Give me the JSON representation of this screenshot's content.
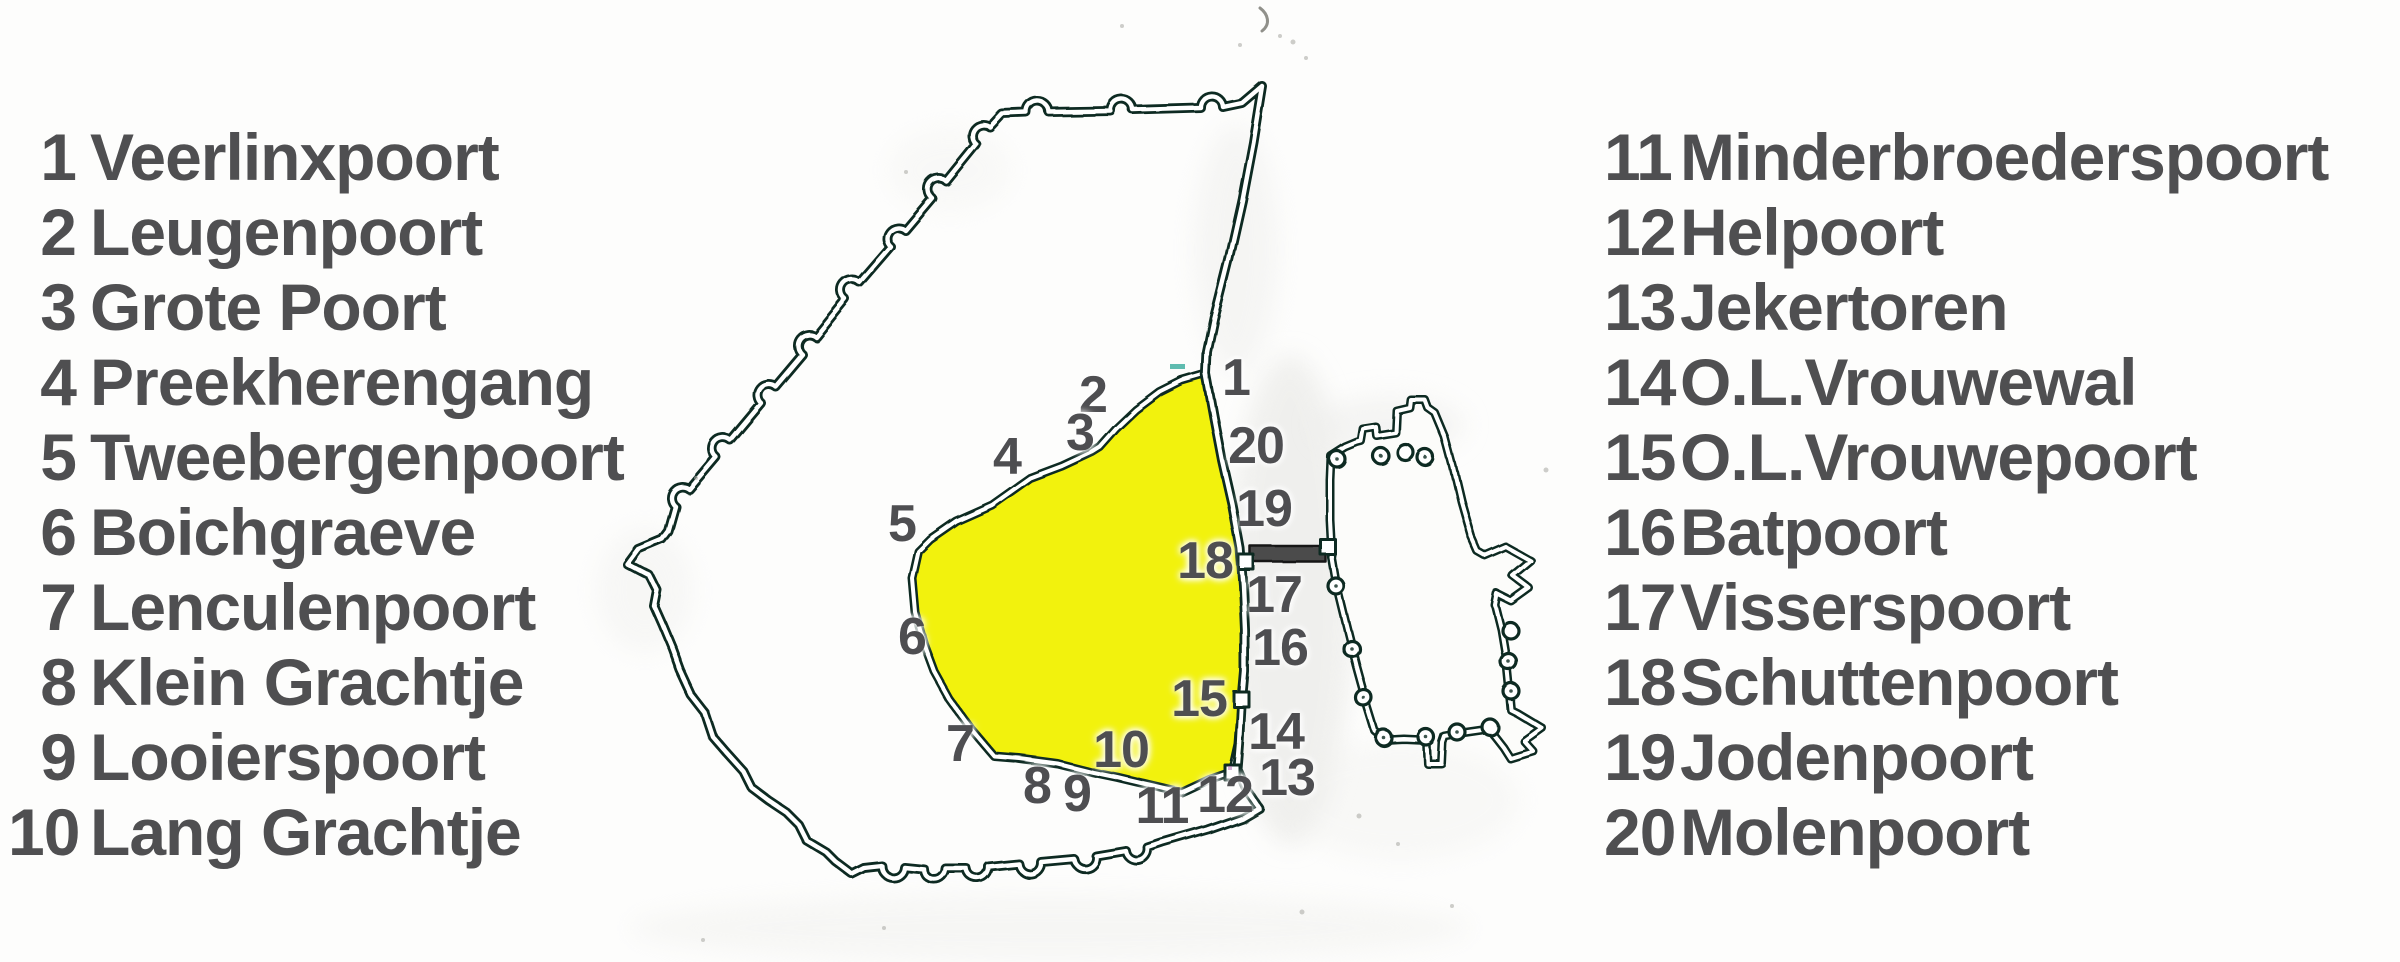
{
  "legend": {
    "left": [
      {
        "number": "1",
        "name": "Veerlinxpoort"
      },
      {
        "number": "2",
        "name": "Leugenpoort"
      },
      {
        "number": "3",
        "name": "Grote Poort"
      },
      {
        "number": "4",
        "name": "Preekherengang"
      },
      {
        "number": "5",
        "name": "Tweebergenpoort"
      },
      {
        "number": "6",
        "name": "Boichgraeve"
      },
      {
        "number": "7",
        "name": "Lenculenpoort"
      },
      {
        "number": "8",
        "name": "Klein Grachtje"
      },
      {
        "number": "9",
        "name": "Looierspoort"
      },
      {
        "number": "10",
        "name": "Lang Grachtje"
      }
    ],
    "right": [
      {
        "number": "11",
        "name": "Minderbroederspoort"
      },
      {
        "number": "12",
        "name": "Helpoort"
      },
      {
        "number": "13",
        "name": "Jekertoren"
      },
      {
        "number": "14",
        "name": "O.L.Vrouwewal"
      },
      {
        "number": "15",
        "name": "O.L.Vrouwepoort"
      },
      {
        "number": "16",
        "name": "Batpoort"
      },
      {
        "number": "17",
        "name": "Visserspoort"
      },
      {
        "number": "18",
        "name": "Schuttenpoort"
      },
      {
        "number": "19",
        "name": "Jodenpoort"
      },
      {
        "number": "20",
        "name": "Molenpoort"
      }
    ]
  },
  "map": {
    "labels": [
      "1",
      "2",
      "3",
      "4",
      "5",
      "6",
      "7",
      "8",
      "9",
      "10",
      "11",
      "12",
      "13",
      "14",
      "15",
      "16",
      "17",
      "18",
      "19",
      "20"
    ],
    "colors": {
      "highlight_yellow": "#f2f20e",
      "wall_line": "#0f2b22",
      "bridge_gray": "#4c4c4c",
      "label_gray": "#4e4e51"
    }
  }
}
